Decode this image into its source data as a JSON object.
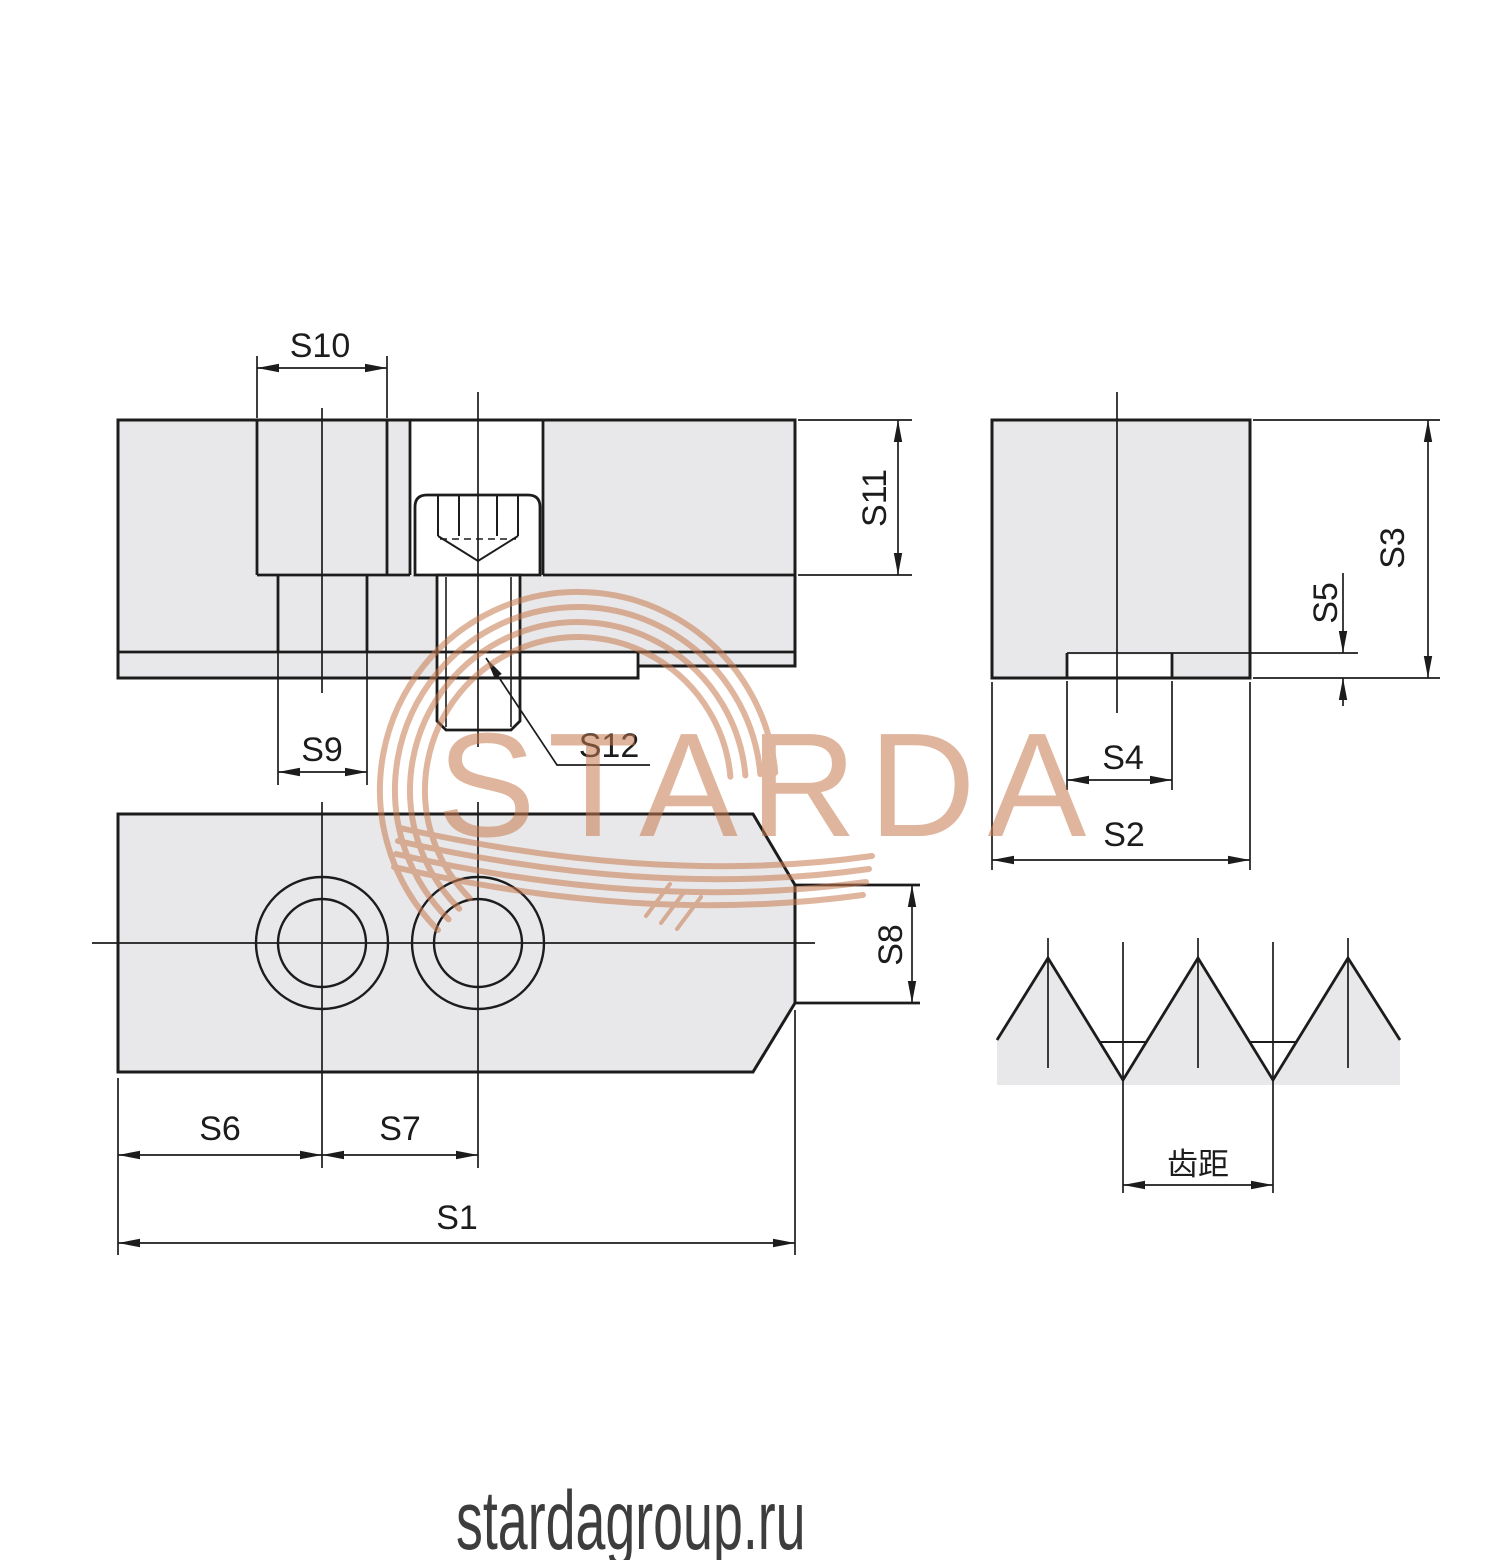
{
  "watermark": {
    "brand_text": "STARDA"
  },
  "footer": {
    "site_url": "stardagroup.ru"
  },
  "colors": {
    "part_fill": "#e8e8ea",
    "line": "#1c1c1c",
    "watermark_accent": "#c87a4e",
    "footer_text": "#3d3d3d"
  },
  "views": {
    "side_section": {
      "title": "side-section-of-jaw-with-screw",
      "dims": {
        "s9": "S9",
        "s10": "S10",
        "s11": "S11",
        "s12": "S12"
      }
    },
    "end_view": {
      "title": "end-view-of-jaw",
      "dims": {
        "s2": "S2",
        "s3": "S3",
        "s4": "S4",
        "s5": "S5"
      }
    },
    "plan_view": {
      "title": "plan-view-of-jaw",
      "dims": {
        "s1": "S1",
        "s6": "S6",
        "s7": "S7",
        "s8": "S8"
      }
    },
    "serration_detail": {
      "title": "serration-tooth-profile",
      "dims": {
        "pitch": "齿距"
      }
    }
  }
}
